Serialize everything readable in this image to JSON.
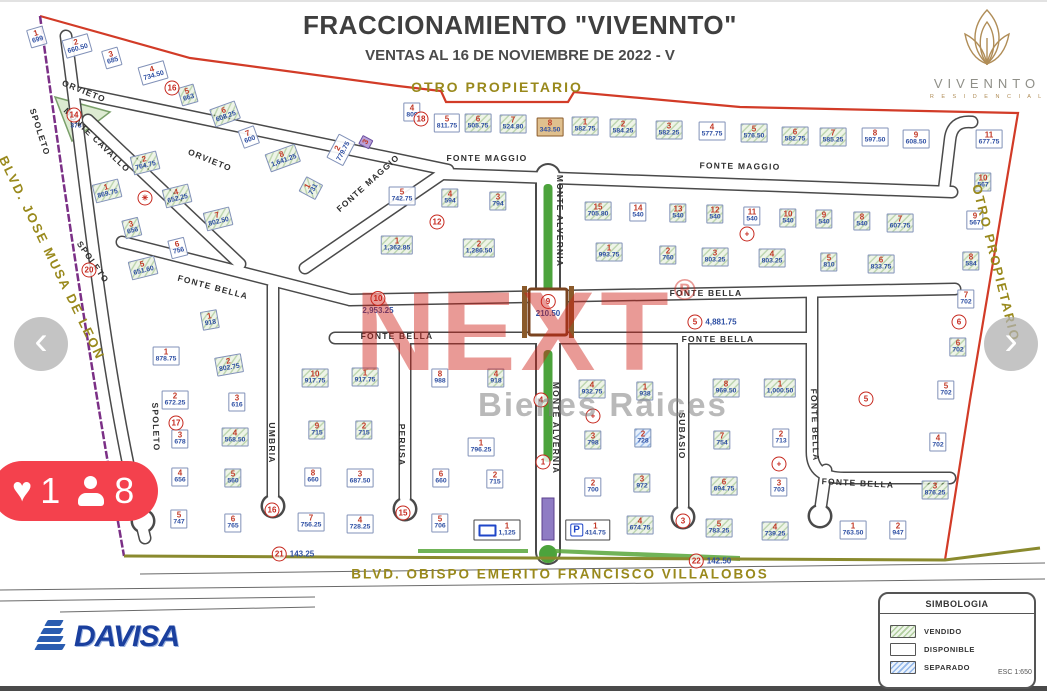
{
  "header": {
    "title": "FRACCIONAMIENTO \"VIVENNTO\"",
    "subtitle": "VENTAS AL 16 DE NOVIEMBRE DE 2022 - V"
  },
  "brand": {
    "name": "VIVENNTO",
    "sub": "R E S I D E N C I A L"
  },
  "watermark": {
    "text": "NEXT",
    "reg": "®",
    "sub": "Bienes Raices"
  },
  "carousel": {
    "prev": "‹",
    "next": "›"
  },
  "badge": {
    "likes": "1",
    "views": "8"
  },
  "legend": {
    "title": "SIMBOLOGIA",
    "items": [
      {
        "label": "VENDIDO",
        "status": "v"
      },
      {
        "label": "DISPONIBLE",
        "status": "d"
      },
      {
        "label": "SEPARADO",
        "status": "s"
      }
    ]
  },
  "scale": "ESC 1:650",
  "davisa": "DAVISA",
  "labels": [
    {
      "t": "OTRO PROPIETARIO",
      "x": 497,
      "y": 87,
      "r": 0,
      "fs": 14
    },
    {
      "t": "OTRO PROPIETARIO",
      "x": 996,
      "y": 263,
      "r": 76,
      "fs": 13
    },
    {
      "t": "BLVD. JOSE MUSA DE LEON",
      "x": 52,
      "y": 258,
      "r": 64,
      "fs": 13
    },
    {
      "t": "BLVD. OBISPO EMERITO FRANCISCO VILLALOBOS",
      "x": 560,
      "y": 574,
      "r": 0,
      "fs": 13.5
    }
  ],
  "streets": [
    {
      "t": "ORVIETO",
      "x": 84,
      "y": 91,
      "r": 22
    },
    {
      "t": "ORVIETO",
      "x": 210,
      "y": 160,
      "r": 22
    },
    {
      "t": "MONTE CAVALLO",
      "x": 97,
      "y": 140,
      "r": 44
    },
    {
      "t": "SPOLETO",
      "x": 40,
      "y": 132,
      "r": 72
    },
    {
      "t": "SPOLETO",
      "x": 93,
      "y": 262,
      "r": 55
    },
    {
      "t": "SPOLETO",
      "x": 156,
      "y": 427,
      "r": 88
    },
    {
      "t": "FONTE MAGGIO",
      "x": 368,
      "y": 183,
      "r": -42
    },
    {
      "t": "FONTE MAGGIO",
      "x": 487,
      "y": 158,
      "r": 0
    },
    {
      "t": "FONTE MAGGIO",
      "x": 740,
      "y": 166,
      "r": 1
    },
    {
      "t": "FONTE BELLA",
      "x": 213,
      "y": 287,
      "r": 15
    },
    {
      "t": "FONTE BELLA",
      "x": 706,
      "y": 293,
      "r": 0
    },
    {
      "t": "FONTE BELLA",
      "x": 397,
      "y": 336,
      "r": 0
    },
    {
      "t": "FONTE BELLA",
      "x": 718,
      "y": 339,
      "r": 0
    },
    {
      "t": "FONTE BELLA",
      "x": 815,
      "y": 425,
      "r": 88
    },
    {
      "t": "FONTE BELLA",
      "x": 858,
      "y": 483,
      "r": 3
    },
    {
      "t": "MONTE ALVERNIA",
      "x": 560,
      "y": 221,
      "r": 90
    },
    {
      "t": "MONTE ALVERNIA",
      "x": 556,
      "y": 428,
      "r": 90
    },
    {
      "t": "UMBRIA",
      "x": 272,
      "y": 443,
      "r": 90
    },
    {
      "t": "PERUSA",
      "x": 402,
      "y": 445,
      "r": 90
    },
    {
      "t": "SUBASIO",
      "x": 682,
      "y": 436,
      "r": 90
    }
  ],
  "markers": [
    {
      "n": "14",
      "x": 74,
      "y": 115
    },
    {
      "n": "16",
      "x": 172,
      "y": 88
    },
    {
      "n": "18",
      "x": 421,
      "y": 119
    },
    {
      "n": "12",
      "x": 437,
      "y": 222
    },
    {
      "n": "✳",
      "x": 145,
      "y": 198
    },
    {
      "n": "20",
      "x": 89,
      "y": 270
    },
    {
      "n": "10",
      "x": 378,
      "y": 303,
      "v": "2,953.25",
      "vp": "below"
    },
    {
      "n": "9",
      "x": 548,
      "y": 306,
      "v": "210.50",
      "vp": "below"
    },
    {
      "n": "5",
      "x": 712,
      "y": 322,
      "v": "4,881.75",
      "vp": "right"
    },
    {
      "n": "+",
      "x": 747,
      "y": 234
    },
    {
      "n": "+",
      "x": 593,
      "y": 416
    },
    {
      "n": "+",
      "x": 779,
      "y": 464
    },
    {
      "n": "17",
      "x": 176,
      "y": 423
    },
    {
      "n": "16",
      "x": 272,
      "y": 510
    },
    {
      "n": "15",
      "x": 403,
      "y": 513
    },
    {
      "n": "3",
      "x": 683,
      "y": 521
    },
    {
      "n": "1",
      "x": 543,
      "y": 462
    },
    {
      "n": "4",
      "x": 541,
      "y": 400
    },
    {
      "n": "6",
      "x": 959,
      "y": 322
    },
    {
      "n": "5",
      "x": 866,
      "y": 399
    },
    {
      "n": "21",
      "x": 293,
      "y": 554,
      "v": "143.25",
      "vp": "right"
    },
    {
      "n": "22",
      "x": 710,
      "y": 561,
      "v": "142.50",
      "vp": "right"
    }
  ],
  "lots": [
    {
      "n": "1",
      "a": "699",
      "x": 37,
      "y": 37,
      "s": "d",
      "r": -16
    },
    {
      "n": "2",
      "a": "660.50",
      "x": 77,
      "y": 46,
      "s": "d",
      "r": -16
    },
    {
      "n": "3",
      "a": "685",
      "x": 112,
      "y": 58,
      "s": "d",
      "r": -16
    },
    {
      "n": "4",
      "a": "734.50",
      "x": 153,
      "y": 73,
      "s": "d",
      "r": -16
    },
    {
      "n": "5",
      "a": "663",
      "x": 188,
      "y": 95,
      "s": "v",
      "r": -16
    },
    {
      "n": "6",
      "a": "608.25",
      "x": 225,
      "y": 114,
      "s": "v",
      "r": -20
    },
    {
      "n": "7",
      "a": "600",
      "x": 249,
      "y": 137,
      "s": "d",
      "r": -20
    },
    {
      "n": "8",
      "a": "1,641.25",
      "x": 283,
      "y": 158,
      "s": "v",
      "r": -20
    },
    {
      "n": "2",
      "a": "779.75",
      "x": 341,
      "y": 150,
      "s": "d",
      "r": -62
    },
    {
      "n": "3",
      "a": "",
      "x": 366,
      "y": 142,
      "s": "p",
      "r": -62
    },
    {
      "n": "1",
      "a": "731",
      "x": 311,
      "y": 188,
      "s": "v",
      "r": -62
    },
    {
      "n": "2",
      "a": "764.75",
      "x": 145,
      "y": 163,
      "s": "v",
      "r": -14
    },
    {
      "n": "1",
      "a": "869.75",
      "x": 107,
      "y": 191,
      "s": "v",
      "r": -14
    },
    {
      "n": "4",
      "a": "652.25",
      "x": 177,
      "y": 196,
      "s": "v",
      "r": -14
    },
    {
      "n": "3",
      "a": "656",
      "x": 132,
      "y": 228,
      "s": "v",
      "r": -14
    },
    {
      "n": "7",
      "a": "802.50",
      "x": 218,
      "y": 219,
      "s": "v",
      "r": -14
    },
    {
      "n": "6",
      "a": "756",
      "x": 178,
      "y": 248,
      "s": "d",
      "r": -14
    },
    {
      "n": "5",
      "a": "651.60",
      "x": 143,
      "y": 268,
      "s": "v",
      "r": -14
    },
    {
      "n": "5",
      "a": "742.75",
      "x": 402,
      "y": 196,
      "s": "d"
    },
    {
      "n": "4",
      "a": "594",
      "x": 450,
      "y": 198,
      "s": "v"
    },
    {
      "n": "3",
      "a": "794",
      "x": 498,
      "y": 201,
      "s": "v"
    },
    {
      "n": "1",
      "a": "1,362.85",
      "x": 397,
      "y": 245,
      "s": "v"
    },
    {
      "n": "2",
      "a": "1,286.50",
      "x": 479,
      "y": 248,
      "s": "v"
    },
    {
      "n": "4",
      "a": "809",
      "x": 412,
      "y": 112,
      "s": "d"
    },
    {
      "n": "5",
      "a": "811.75",
      "x": 447,
      "y": 123,
      "s": "d"
    },
    {
      "n": "6",
      "a": "505.75",
      "x": 478,
      "y": 123,
      "s": "v"
    },
    {
      "n": "7",
      "a": "524.80",
      "x": 513,
      "y": 124,
      "s": "v"
    },
    {
      "n": "8",
      "a": "343.50",
      "x": 550,
      "y": 127,
      "s": "b"
    },
    {
      "n": "1",
      "a": "582.75",
      "x": 585,
      "y": 126,
      "s": "v"
    },
    {
      "n": "2",
      "a": "584.25",
      "x": 623,
      "y": 128,
      "s": "v"
    },
    {
      "n": "3",
      "a": "582.25",
      "x": 669,
      "y": 130,
      "s": "v"
    },
    {
      "n": "4",
      "a": "577.75",
      "x": 712,
      "y": 131,
      "s": "d"
    },
    {
      "n": "5",
      "a": "576.50",
      "x": 754,
      "y": 133,
      "s": "v"
    },
    {
      "n": "6",
      "a": "582.75",
      "x": 795,
      "y": 136,
      "s": "v"
    },
    {
      "n": "7",
      "a": "585.25",
      "x": 833,
      "y": 137,
      "s": "v"
    },
    {
      "n": "8",
      "a": "597.50",
      "x": 875,
      "y": 137,
      "s": "d"
    },
    {
      "n": "9",
      "a": "608.50",
      "x": 916,
      "y": 139,
      "s": "d"
    },
    {
      "n": "11",
      "a": "677.75",
      "x": 989,
      "y": 139,
      "s": "d"
    },
    {
      "n": "10",
      "a": "567",
      "x": 983,
      "y": 182,
      "s": "v"
    },
    {
      "n": "15",
      "a": "705.80",
      "x": 598,
      "y": 211,
      "s": "v"
    },
    {
      "n": "14",
      "a": "540",
      "x": 638,
      "y": 212,
      "s": "d"
    },
    {
      "n": "13",
      "a": "540",
      "x": 678,
      "y": 213,
      "s": "v"
    },
    {
      "n": "12",
      "a": "540",
      "x": 715,
      "y": 214,
      "s": "v"
    },
    {
      "n": "11",
      "a": "540",
      "x": 752,
      "y": 216,
      "s": "d"
    },
    {
      "n": "10",
      "a": "540",
      "x": 788,
      "y": 218,
      "s": "v"
    },
    {
      "n": "9",
      "a": "540",
      "x": 824,
      "y": 219,
      "s": "v"
    },
    {
      "n": "8",
      "a": "540",
      "x": 862,
      "y": 221,
      "s": "v"
    },
    {
      "n": "7",
      "a": "607.75",
      "x": 900,
      "y": 223,
      "s": "v"
    },
    {
      "n": "1",
      "a": "993.75",
      "x": 609,
      "y": 252,
      "s": "v"
    },
    {
      "n": "2",
      "a": "760",
      "x": 668,
      "y": 255,
      "s": "v"
    },
    {
      "n": "3",
      "a": "803.25",
      "x": 715,
      "y": 257,
      "s": "v"
    },
    {
      "n": "4",
      "a": "803.25",
      "x": 772,
      "y": 258,
      "s": "v"
    },
    {
      "n": "5",
      "a": "810",
      "x": 829,
      "y": 262,
      "s": "v"
    },
    {
      "n": "6",
      "a": "833.75",
      "x": 881,
      "y": 264,
      "s": "v"
    },
    {
      "n": "9",
      "a": "567",
      "x": 975,
      "y": 220,
      "s": "d"
    },
    {
      "n": "8",
      "a": "584",
      "x": 971,
      "y": 261,
      "s": "v"
    },
    {
      "n": "7",
      "a": "702",
      "x": 966,
      "y": 299,
      "s": "d"
    },
    {
      "n": "6",
      "a": "702",
      "x": 958,
      "y": 347,
      "s": "v"
    },
    {
      "n": "5",
      "a": "702",
      "x": 946,
      "y": 390,
      "s": "d"
    },
    {
      "n": "4",
      "a": "702",
      "x": 938,
      "y": 442,
      "s": "d"
    },
    {
      "n": "3",
      "a": "876.25",
      "x": 935,
      "y": 490,
      "s": "v"
    },
    {
      "n": "2",
      "a": "947",
      "x": 898,
      "y": 530,
      "s": "d"
    },
    {
      "n": "1",
      "a": "763.50",
      "x": 853,
      "y": 530,
      "s": "d"
    },
    {
      "n": "1",
      "a": "918",
      "x": 210,
      "y": 320,
      "s": "v",
      "r": -10
    },
    {
      "n": "2",
      "a": "802.75",
      "x": 229,
      "y": 365,
      "s": "v",
      "r": -10
    },
    {
      "n": "1",
      "a": "878.75",
      "x": 166,
      "y": 356,
      "s": "d"
    },
    {
      "n": "2",
      "a": "672.25",
      "x": 175,
      "y": 400,
      "s": "d"
    },
    {
      "n": "3",
      "a": "616",
      "x": 237,
      "y": 402,
      "s": "d"
    },
    {
      "n": "3",
      "a": "678",
      "x": 180,
      "y": 439,
      "s": "d"
    },
    {
      "n": "4",
      "a": "568.50",
      "x": 235,
      "y": 437,
      "s": "v"
    },
    {
      "n": "10",
      "a": "917.75",
      "x": 315,
      "y": 378,
      "s": "v"
    },
    {
      "n": "1",
      "a": "917.75",
      "x": 365,
      "y": 377,
      "s": "v"
    },
    {
      "n": "9",
      "a": "715",
      "x": 317,
      "y": 430,
      "s": "v"
    },
    {
      "n": "2",
      "a": "715",
      "x": 364,
      "y": 430,
      "s": "v"
    },
    {
      "n": "4",
      "a": "656",
      "x": 180,
      "y": 477,
      "s": "d"
    },
    {
      "n": "5",
      "a": "560",
      "x": 233,
      "y": 478,
      "s": "v"
    },
    {
      "n": "5",
      "a": "747",
      "x": 179,
      "y": 519,
      "s": "d"
    },
    {
      "n": "6",
      "a": "765",
      "x": 233,
      "y": 523,
      "s": "d"
    },
    {
      "n": "8",
      "a": "660",
      "x": 313,
      "y": 477,
      "s": "d"
    },
    {
      "n": "3",
      "a": "687.50",
      "x": 360,
      "y": 478,
      "s": "d"
    },
    {
      "n": "7",
      "a": "756.25",
      "x": 311,
      "y": 522,
      "s": "d"
    },
    {
      "n": "4",
      "a": "728.25",
      "x": 360,
      "y": 524,
      "s": "d"
    },
    {
      "n": "8",
      "a": "988",
      "x": 440,
      "y": 378,
      "s": "d"
    },
    {
      "n": "4",
      "a": "918",
      "x": 496,
      "y": 378,
      "s": "v"
    },
    {
      "n": "1",
      "a": "796.25",
      "x": 481,
      "y": 447,
      "s": "d"
    },
    {
      "n": "6",
      "a": "660",
      "x": 441,
      "y": 478,
      "s": "d"
    },
    {
      "n": "2",
      "a": "715",
      "x": 495,
      "y": 479,
      "s": "d"
    },
    {
      "n": "5",
      "a": "706",
      "x": 440,
      "y": 523,
      "s": "d"
    },
    {
      "n": "1",
      "a": "1,125",
      "x": 497,
      "y": 530,
      "s": "e",
      "i": "R"
    },
    {
      "n": "1",
      "a": "414.75",
      "x": 588,
      "y": 530,
      "s": "e",
      "i": "P"
    },
    {
      "n": "2",
      "a": "700",
      "x": 593,
      "y": 487,
      "s": "d"
    },
    {
      "n": "3",
      "a": "972",
      "x": 642,
      "y": 483,
      "s": "v"
    },
    {
      "n": "4",
      "a": "932.75",
      "x": 592,
      "y": 389,
      "s": "v"
    },
    {
      "n": "1",
      "a": "938",
      "x": 645,
      "y": 391,
      "s": "v"
    },
    {
      "n": "3",
      "a": "798",
      "x": 593,
      "y": 440,
      "s": "v"
    },
    {
      "n": "2",
      "a": "728",
      "x": 643,
      "y": 438,
      "s": "s"
    },
    {
      "n": "4",
      "a": "674.75",
      "x": 640,
      "y": 525,
      "s": "v"
    },
    {
      "n": "8",
      "a": "969.50",
      "x": 726,
      "y": 388,
      "s": "v"
    },
    {
      "n": "1",
      "a": "1,000.50",
      "x": 780,
      "y": 388,
      "s": "v"
    },
    {
      "n": "7",
      "a": "754",
      "x": 722,
      "y": 440,
      "s": "v"
    },
    {
      "n": "2",
      "a": "713",
      "x": 781,
      "y": 438,
      "s": "d"
    },
    {
      "n": "6",
      "a": "694.75",
      "x": 724,
      "y": 486,
      "s": "v"
    },
    {
      "n": "3",
      "a": "703",
      "x": 779,
      "y": 487,
      "s": "d"
    },
    {
      "n": "5",
      "a": "783.25",
      "x": 719,
      "y": 528,
      "s": "v"
    },
    {
      "n": "4",
      "a": "739.25",
      "x": 775,
      "y": 531,
      "s": "v"
    },
    {
      "n": "",
      "a": "373",
      "x": 76,
      "y": 127,
      "s": "k"
    }
  ]
}
